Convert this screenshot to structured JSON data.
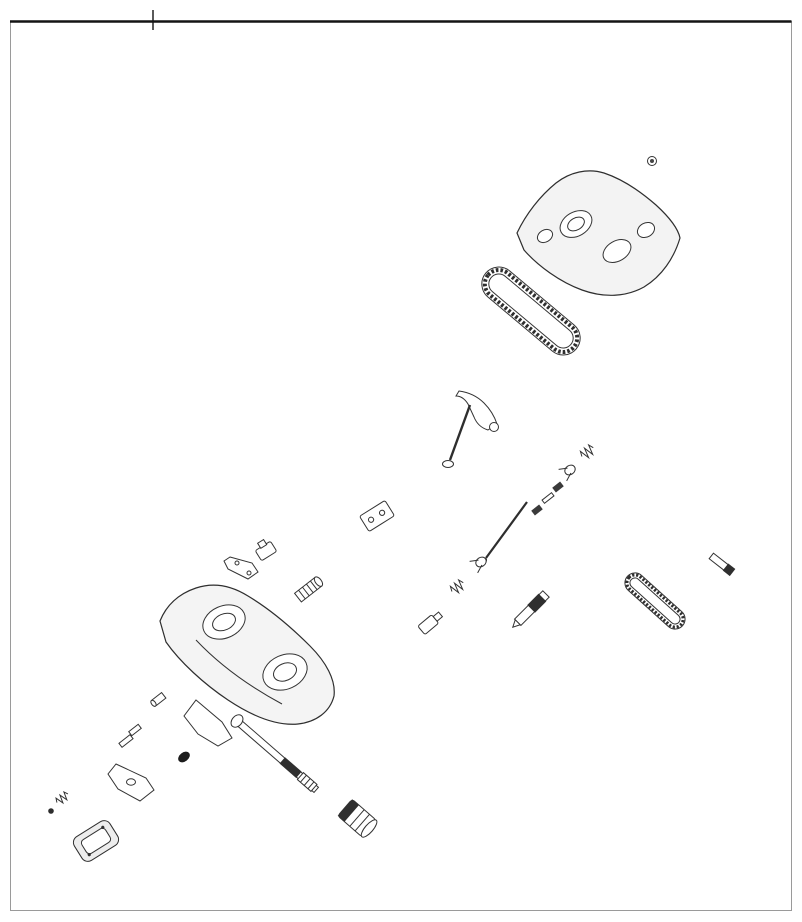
{
  "figure": {
    "assembly_ref": "1",
    "watermark": "www.polarisersatzteile.de",
    "copyright": "© 2012 Polaris Sales Inc."
  },
  "colors": {
    "line": "#333333",
    "watermark": "#cfcfcf"
  },
  "callouts": [
    {
      "part": "2",
      "x": 588,
      "y": 121,
      "tx": 610,
      "ty": 139,
      "segs": [
        [
          586,
          127,
          519,
          221
        ]
      ]
    },
    {
      "part": "3",
      "x": 514,
      "y": 165,
      "tx": 549,
      "ty": 203
    },
    {
      "part": "70",
      "x": 688,
      "y": 175,
      "tx": 654,
      "ty": 162
    },
    {
      "part": "67",
      "x": 669,
      "y": 201,
      "tx": 638,
      "ty": 188
    },
    {
      "part": "80",
      "x": 762,
      "y": 192,
      "tx": 739,
      "ty": 155,
      "big": true
    },
    {
      "part": "34",
      "x": 707,
      "y": 240,
      "tx": 688,
      "ty": 227
    },
    {
      "part": "69",
      "x": 490,
      "y": 235,
      "tx": 530,
      "ty": 262,
      "t2": [
        520,
        294
      ]
    },
    {
      "part": "7",
      "x": 604,
      "y": 316,
      "tx": 596,
      "ty": 306
    },
    {
      "part": "5",
      "x": 585,
      "y": 340,
      "tx": 558,
      "ty": 332
    },
    {
      "part": "8",
      "x": 563,
      "y": 362,
      "tx": 546,
      "ty": 353
    },
    {
      "part": "12",
      "x": 547,
      "y": 384,
      "tx": 519,
      "ty": 372
    },
    {
      "part": "10",
      "x": 455,
      "y": 312,
      "tx": 477,
      "ty": 347,
      "t2": [
        490,
        354
      ]
    },
    {
      "part": "9",
      "x": 439,
      "y": 379,
      "tx": 462,
      "ty": 393
    },
    {
      "part": "11",
      "x": 403,
      "y": 423,
      "tx": 433,
      "ty": 447
    },
    {
      "part": "15",
      "x": 384,
      "y": 448,
      "tx": 414,
      "ty": 477
    },
    {
      "part": "63",
      "x": 369,
      "y": 463,
      "tx": 404,
      "ty": 489
    },
    {
      "part": "14",
      "x": 353,
      "y": 488,
      "tx": 372,
      "ty": 511
    },
    {
      "part": "16",
      "x": 391,
      "y": 551,
      "tx": 364,
      "ty": 533
    },
    {
      "part": "17",
      "x": 373,
      "y": 576,
      "tx": 348,
      "ty": 560
    },
    {
      "part": "18",
      "x": 337,
      "y": 605,
      "tx": 314,
      "ty": 589
    },
    {
      "part": "79",
      "x": 245,
      "y": 341,
      "tx": 285,
      "ty": 366
    },
    {
      "part": "4",
      "x": 367,
      "y": 372,
      "tx": 349,
      "ty": 360
    },
    {
      "part": "4",
      "x": 310,
      "y": 429,
      "tx": 293,
      "ty": 417
    },
    {
      "part": "41",
      "x": 287,
      "y": 473,
      "tx": 267,
      "ty": 501
    },
    {
      "part": "42",
      "x": 305,
      "y": 546,
      "tx": 291,
      "ty": 536
    },
    {
      "part": "43",
      "x": 288,
      "y": 563,
      "tx": 270,
      "ty": 554
    },
    {
      "part": "44",
      "x": 273,
      "y": 580,
      "tx": 250,
      "ty": 568
    },
    {
      "part": "6",
      "x": 133,
      "y": 571,
      "tx": 170,
      "ty": 596
    },
    {
      "part": "63",
      "x": 300,
      "y": 648,
      "tx": 281,
      "ty": 635
    },
    {
      "part": "2",
      "x": 19,
      "y": 644,
      "tx": 38,
      "ty": 652,
      "segs": [
        [
          52,
          646,
          86,
          618
        ],
        [
          86,
          618,
          176,
          652
        ]
      ]
    },
    {
      "part": "78",
      "x": 146,
      "y": 673,
      "tx": 168,
      "ty": 687
    },
    {
      "part": "77",
      "x": 135,
      "y": 682,
      "tx": 156,
      "ty": 697
    },
    {
      "part": "13",
      "x": 114,
      "y": 701,
      "tx": 144,
      "ty": 712
    },
    {
      "part": "46",
      "x": 108,
      "y": 709,
      "tx": 140,
      "ty": 719
    },
    {
      "part": "49",
      "x": 102,
      "y": 721,
      "tx": 132,
      "ty": 729
    },
    {
      "part": "47",
      "x": 93,
      "y": 733,
      "tx": 123,
      "ty": 740
    },
    {
      "part": "48",
      "x": 85,
      "y": 748,
      "tx": 114,
      "ty": 752
    },
    {
      "part": "82",
      "x": 189,
      "y": 719,
      "tx": 174,
      "ty": 713
    },
    {
      "part": "50",
      "x": 190,
      "y": 737,
      "tx": 172,
      "ty": 746
    },
    {
      "part": "56",
      "x": 200,
      "y": 763,
      "tx": 187,
      "ty": 758
    },
    {
      "part": "57",
      "x": 193,
      "y": 798,
      "tx": 176,
      "ty": 782
    },
    {
      "part": "81",
      "x": 187,
      "y": 812,
      "tx": 170,
      "ty": 792
    },
    {
      "part": "58",
      "x": 174,
      "y": 825,
      "tx": 157,
      "ty": 802
    },
    {
      "part": "51",
      "x": 163,
      "y": 837,
      "tx": 140,
      "ty": 793
    },
    {
      "part": "13",
      "x": 143,
      "y": 848,
      "tx": 109,
      "ty": 810
    },
    {
      "part": "54",
      "x": 124,
      "y": 865,
      "tx": 98,
      "ty": 848
    },
    {
      "part": "55",
      "x": 47,
      "y": 841,
      "tx": 74,
      "ty": 851,
      "arrow": true
    },
    {
      "part": "53",
      "x": 36,
      "y": 819,
      "tx": 49,
      "ty": 812
    },
    {
      "part": "52",
      "x": 46,
      "y": 793,
      "tx": 60,
      "ty": 796
    },
    {
      "part": "59",
      "x": 313,
      "y": 747,
      "tx": 284,
      "ty": 762
    },
    {
      "part": "60",
      "x": 297,
      "y": 816,
      "tx": 318,
      "ty": 798
    },
    {
      "part": "15",
      "x": 306,
      "y": 828,
      "tx": 328,
      "ty": 805
    },
    {
      "part": "62",
      "x": 387,
      "y": 799,
      "tx": 360,
      "ty": 816
    },
    {
      "part": "35",
      "x": 358,
      "y": 865,
      "tx": 377,
      "ty": 843
    },
    {
      "part": "64",
      "x": 425,
      "y": 828,
      "tx": 399,
      "ty": 847
    },
    {
      "part": "65",
      "x": 432,
      "y": 837,
      "tx": 404,
      "ty": 856
    },
    {
      "part": "74",
      "x": 445,
      "y": 848,
      "tx": 416,
      "ty": 868
    },
    {
      "part": "66",
      "x": 455,
      "y": 857,
      "tx": 429,
      "ty": 874
    },
    {
      "part": "75",
      "x": 375,
      "y": 882,
      "tx": 405,
      "ty": 872
    },
    {
      "part": "45",
      "x": 409,
      "y": 637,
      "tx": 427,
      "ty": 622
    },
    {
      "part": "29",
      "x": 503,
      "y": 591,
      "tx": 524,
      "ty": 601
    },
    {
      "part": "38",
      "x": 503,
      "y": 573,
      "tx": 484,
      "ty": 562
    },
    {
      "part": "39",
      "x": 479,
      "y": 600,
      "tx": 461,
      "ty": 586
    },
    {
      "part": "73",
      "x": 466,
      "y": 612,
      "tx": 449,
      "ty": 599
    },
    {
      "part": "72",
      "x": 455,
      "y": 626,
      "tx": 435,
      "ty": 611
    },
    {
      "part": "76",
      "x": 565,
      "y": 633,
      "tx": 517,
      "ty": 630,
      "segs": [
        [
          553,
          606,
          553,
          630
        ]
      ]
    },
    {
      "part": "30",
      "x": 529,
      "y": 667,
      "tx": 505,
      "ty": 651
    },
    {
      "part": "27",
      "x": 513,
      "y": 682,
      "tx": 491,
      "ty": 661
    },
    {
      "part": "26",
      "x": 505,
      "y": 693,
      "tx": 483,
      "ty": 670
    },
    {
      "part": "24",
      "x": 494,
      "y": 705,
      "tx": 474,
      "ty": 684
    },
    {
      "part": "13",
      "x": 478,
      "y": 718,
      "tx": 457,
      "ty": 703
    },
    {
      "part": "32",
      "x": 461,
      "y": 734,
      "tx": 439,
      "ty": 716
    },
    {
      "part": "33",
      "x": 441,
      "y": 751,
      "tx": 419,
      "ty": 738
    },
    {
      "part": "72",
      "x": 643,
      "y": 423,
      "tx": 613,
      "ty": 419
    },
    {
      "part": "73",
      "x": 630,
      "y": 447,
      "tx": 603,
      "ty": 439
    },
    {
      "part": "39",
      "x": 622,
      "y": 460,
      "tx": 592,
      "ty": 451
    },
    {
      "part": "38",
      "x": 598,
      "y": 478,
      "tx": 574,
      "ty": 471
    },
    {
      "part": "71",
      "x": 583,
      "y": 498,
      "tx": 561,
      "ty": 488
    },
    {
      "part": "31",
      "x": 573,
      "y": 512,
      "tx": 551,
      "ty": 499
    },
    {
      "part": "71",
      "x": 558,
      "y": 525,
      "tx": 540,
      "ty": 511
    },
    {
      "part": "40",
      "x": 538,
      "y": 540,
      "tx": 514,
      "ty": 527
    },
    {
      "part": "7",
      "x": 700,
      "y": 478,
      "tx": 673,
      "ty": 465
    },
    {
      "part": "19",
      "x": 692,
      "y": 494,
      "tx": 661,
      "ty": 480
    },
    {
      "part": "20",
      "x": 685,
      "y": 506,
      "tx": 650,
      "ty": 492
    },
    {
      "part": "21",
      "x": 674,
      "y": 518,
      "tx": 629,
      "ty": 503
    },
    {
      "part": "22",
      "x": 660,
      "y": 532,
      "tx": 608,
      "ty": 513
    },
    {
      "part": "23",
      "x": 649,
      "y": 545,
      "tx": 596,
      "ty": 524
    },
    {
      "part": "61",
      "x": 637,
      "y": 555,
      "tx": 585,
      "ty": 534
    },
    {
      "part": "25",
      "x": 628,
      "y": 569,
      "tx": 597,
      "ty": 544
    },
    {
      "part": "26",
      "x": 616,
      "y": 582,
      "tx": 583,
      "ty": 553
    },
    {
      "part": "27",
      "x": 606,
      "y": 591,
      "tx": 574,
      "ty": 562
    },
    {
      "part": "28",
      "x": 595,
      "y": 602,
      "tx": 570,
      "ty": 576
    },
    {
      "part": "35",
      "x": 760,
      "y": 538,
      "tx": 740,
      "ty": 525
    },
    {
      "part": "36",
      "x": 732,
      "y": 572,
      "tx": 711,
      "ty": 555
    },
    {
      "part": "37",
      "x": 699,
      "y": 600,
      "tx": 668,
      "ty": 601
    },
    {
      "part": "33",
      "x": 673,
      "y": 620,
      "tx": 656,
      "ty": 613
    }
  ]
}
